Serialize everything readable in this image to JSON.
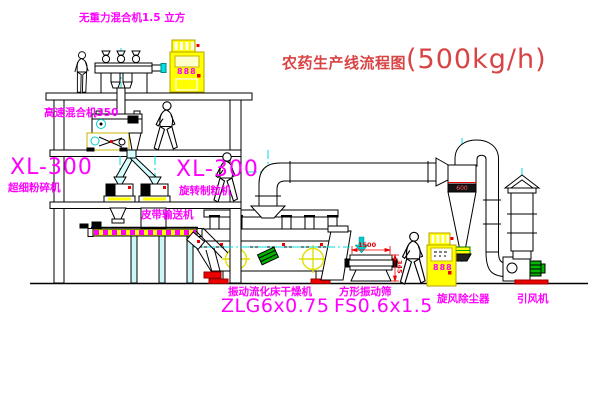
{
  "title": {
    "text": "农药生产线流程图",
    "capacity": "(500kg/h)"
  },
  "labels": {
    "gravity_mixer": "无重力混合机1.5 立方",
    "high_speed_mixer": "高速混合机350",
    "pulverizer_model": "XL-300",
    "pulverizer_name": "超细粉碎机",
    "granulator_model": "XL-300",
    "granulator_name": "旋转制粒机",
    "belt_conveyor": "皮带输送机",
    "fluid_bed_dryer": "振动流化床干燥机",
    "fluid_bed_dryer_model": "ZLG6x0.75",
    "square_sieve": "方形振动筛",
    "square_sieve_model": "FS0.6x1.5",
    "cyclone": "旋风除尘器",
    "induced_draft_fan": "引风机"
  },
  "annotations": {
    "control_cabinet_display_1": "888",
    "control_cabinet_display_2": "888",
    "cyclone_marking": "600",
    "sieve_dim_length": "1500",
    "sieve_dim_height": "345"
  },
  "colors": {
    "label_magenta": "#ff00ff",
    "title_red": "#d84444",
    "line_black": "#000000",
    "equipment_yellow": "#ffff00",
    "centerline_cyan": "#00dcdc",
    "accent_green": "#00b400",
    "accent_red": "#ee0000",
    "background": "#ffffff"
  }
}
